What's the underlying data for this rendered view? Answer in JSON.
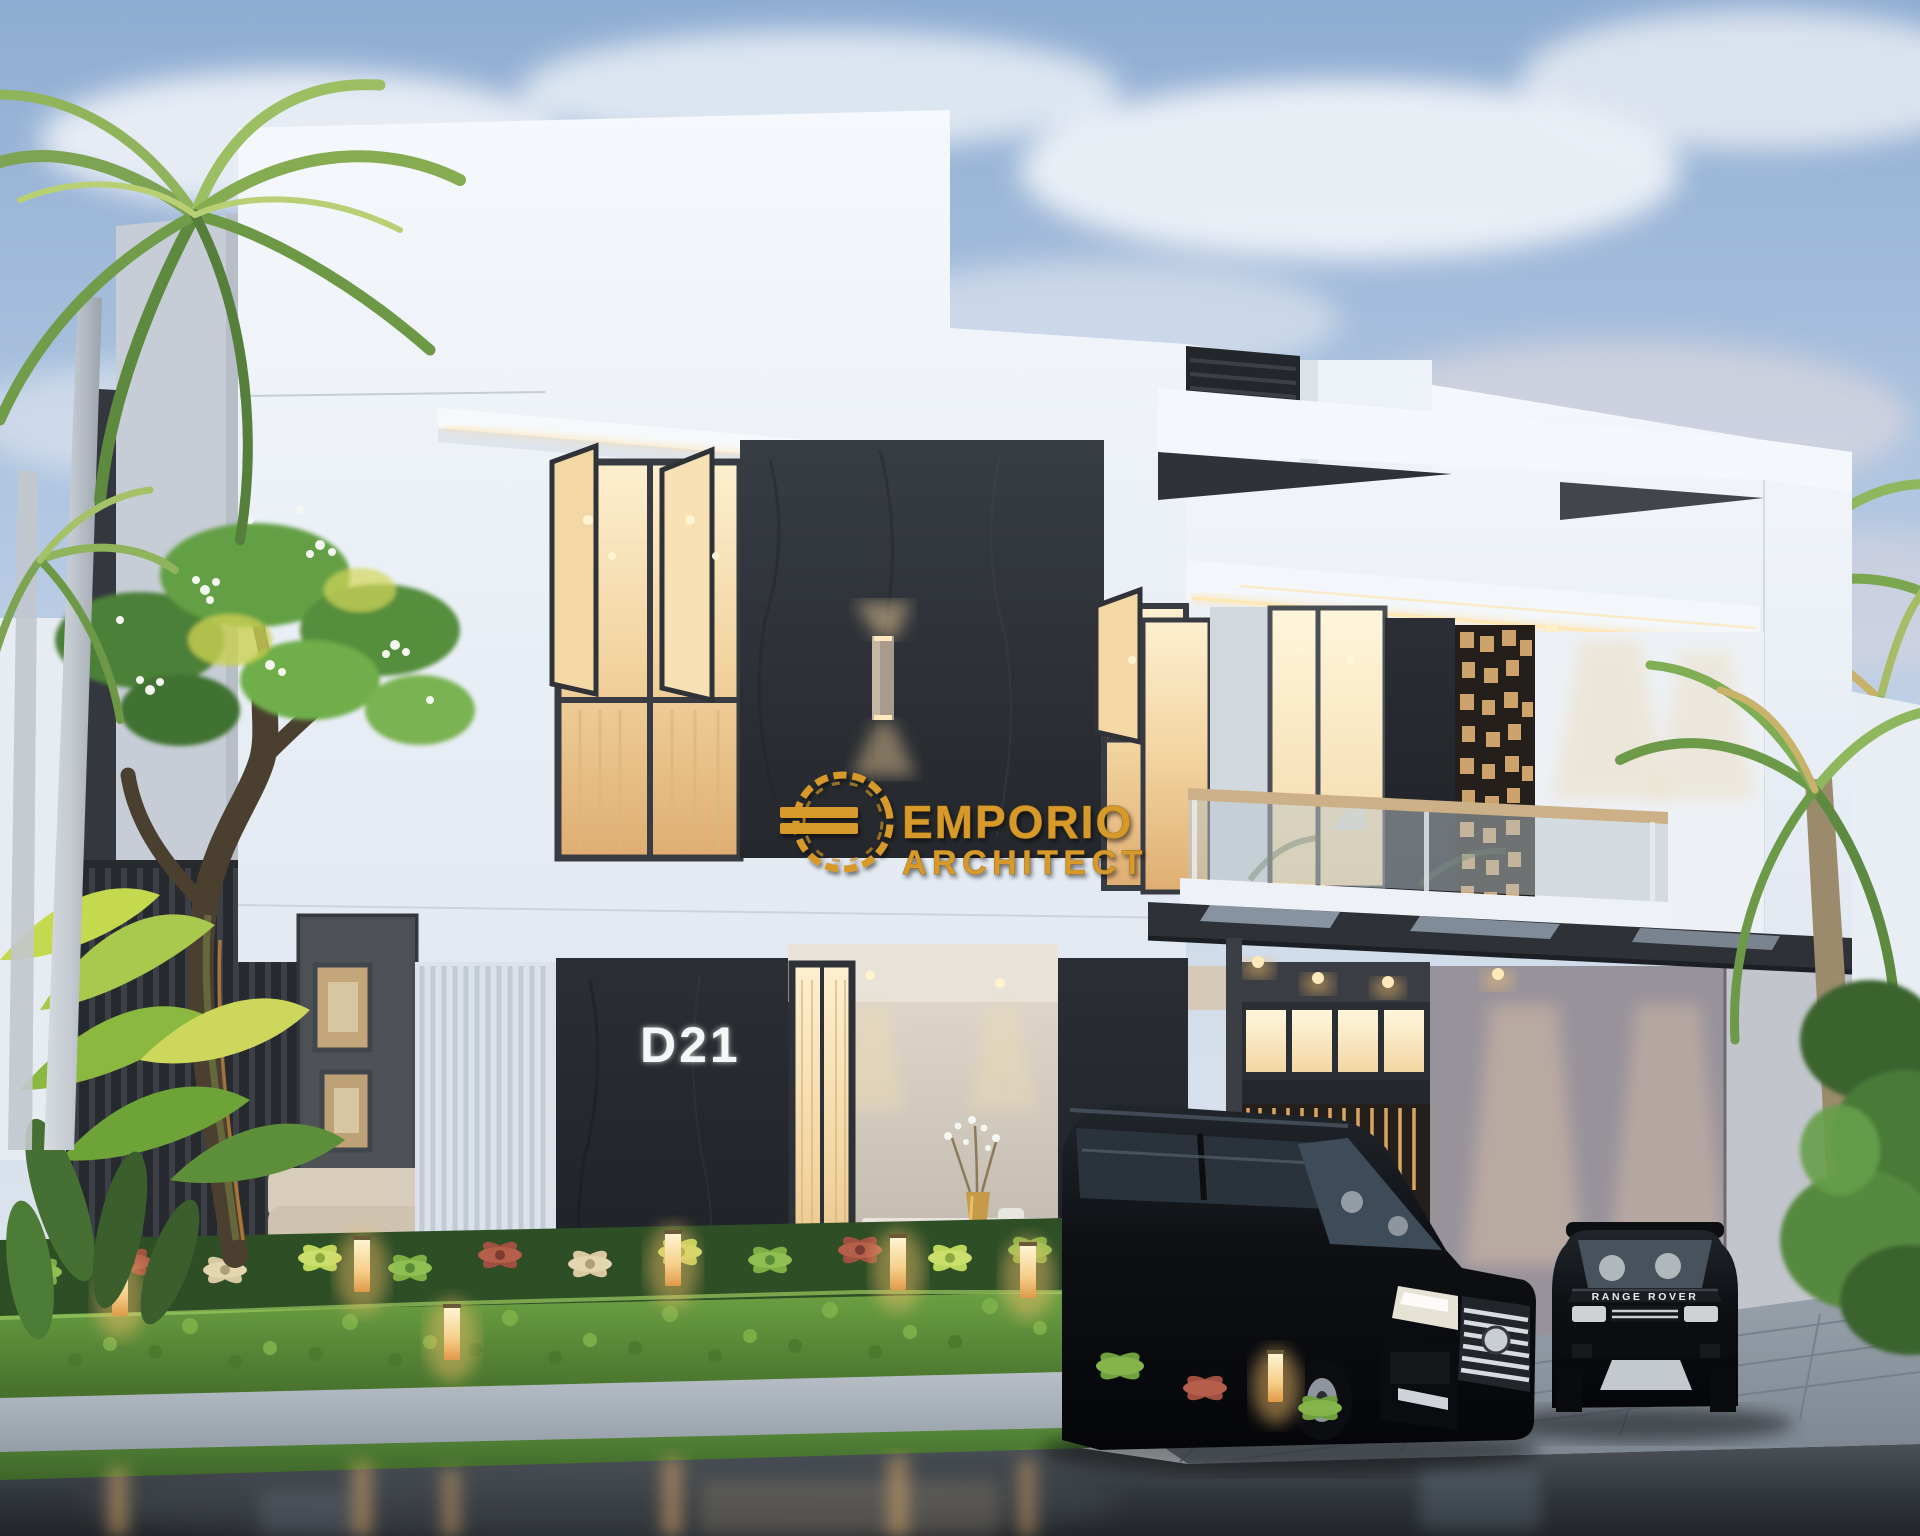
{
  "scene": {
    "type": "exterior-architectural-render",
    "subject": "modern two-storey villa at dusk with carport, garden hedge and two black cars",
    "house": {
      "number": "D21"
    },
    "vehicles": {
      "right_badge": "RANGE ROVER"
    }
  },
  "watermark": {
    "line1": "EMPORIO",
    "line2": "ARCHITECT"
  },
  "colors": {
    "gold": "#D79A2C",
    "gold_dark": "#8A5F12",
    "house_number": "#F4F6F8",
    "badge_text": "#E8EAEC",
    "sky_top": "#8FADD2",
    "sky_horizon": "#E6EAF0",
    "wall_white": "#F3F7FC",
    "stone_dark": "#2B2F35",
    "warm_glass": "#F2D4A0",
    "led_strip": "#FFDF9F",
    "hedge_green": "#6CA043",
    "lawn_green": "#4E7C33",
    "road_gray": "#34393E",
    "planter_gray": "#AAB3BD",
    "car_black": "#0F1114",
    "chrome": "#D7DCE1",
    "screen_wood": "#C9A26B",
    "palm_trunk": "#C9CED6",
    "foliage": "#63A044",
    "flower_white": "#F4F6EF"
  }
}
